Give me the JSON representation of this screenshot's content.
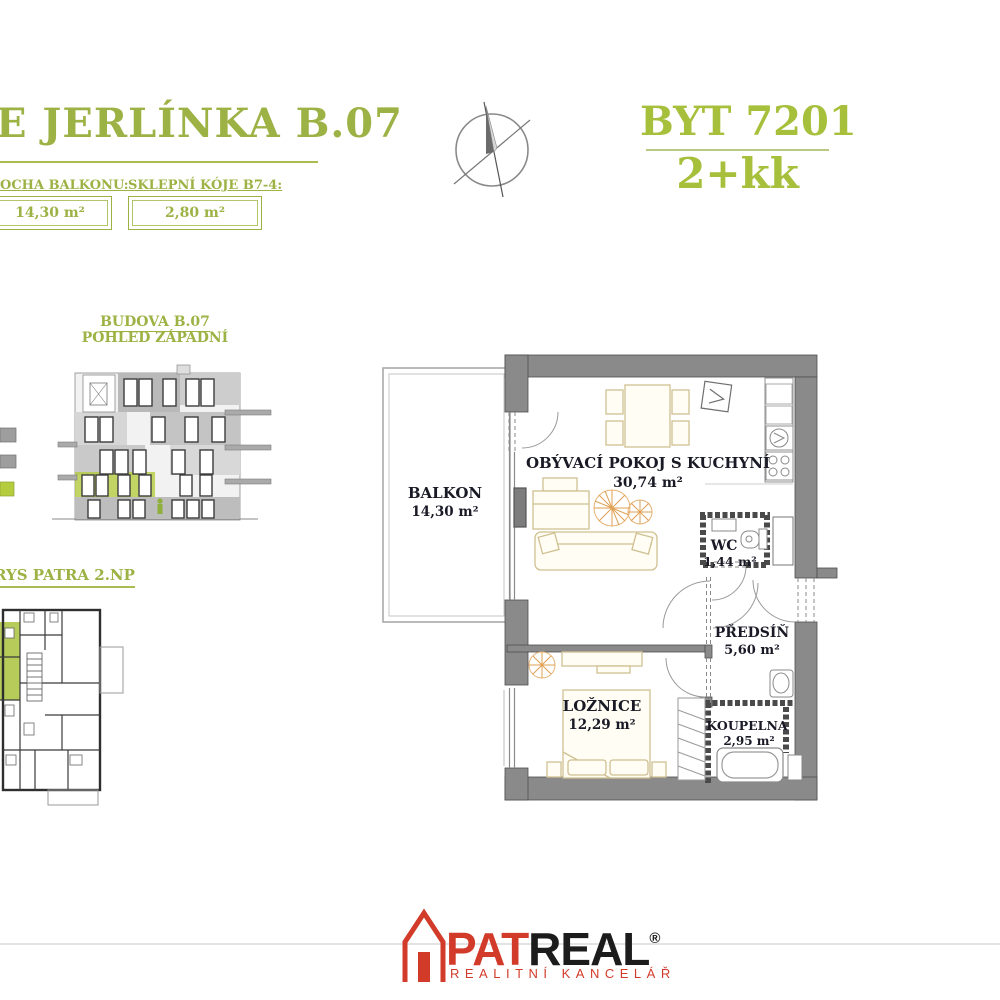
{
  "header": {
    "project_title": "E JERLÍNKA B.07",
    "unit_title": "BYT 7201",
    "unit_layout": "2+kk",
    "balcony_label": "OCHA BALKONU:",
    "balcony_value": "14,30 m²",
    "cellar_label": "SKLEPNÍ KÓJE B7-4:",
    "cellar_value": "2,80 m²"
  },
  "elevation": {
    "title_line1": "BUDOVA  B.07",
    "title_line2": "POHLED ZÁPADNÍ"
  },
  "floor_overview": {
    "title": "RYS PATRA 2.NP"
  },
  "floor_plan": {
    "rooms": [
      {
        "name": "BALKON",
        "area": "14,30 m²"
      },
      {
        "name": "OBÝVACÍ POKOJ S KUCHYNÍ",
        "area": "30,74 m²"
      },
      {
        "name": "WC",
        "area": "1,44 m²"
      },
      {
        "name": "PŘEDSÍŇ",
        "area": "5,60 m²"
      },
      {
        "name": "LOŽNICE",
        "area": "12,29 m²"
      },
      {
        "name": "KOUPELNA",
        "area": "2,95 m²"
      }
    ]
  },
  "footer": {
    "brand_primary": "PAT",
    "brand_secondary": "REAL",
    "registered": "®",
    "tagline": "REALITNÍ KANCELÁŘ"
  },
  "colors": {
    "accent_green": "#a3b83e",
    "highlight_green": "#b5cc3f",
    "wall_gray": "#8a8a8a",
    "logo_red": "#d23b2a",
    "furniture_tan": "#cfc091",
    "plant_orange": "#df9f52"
  }
}
